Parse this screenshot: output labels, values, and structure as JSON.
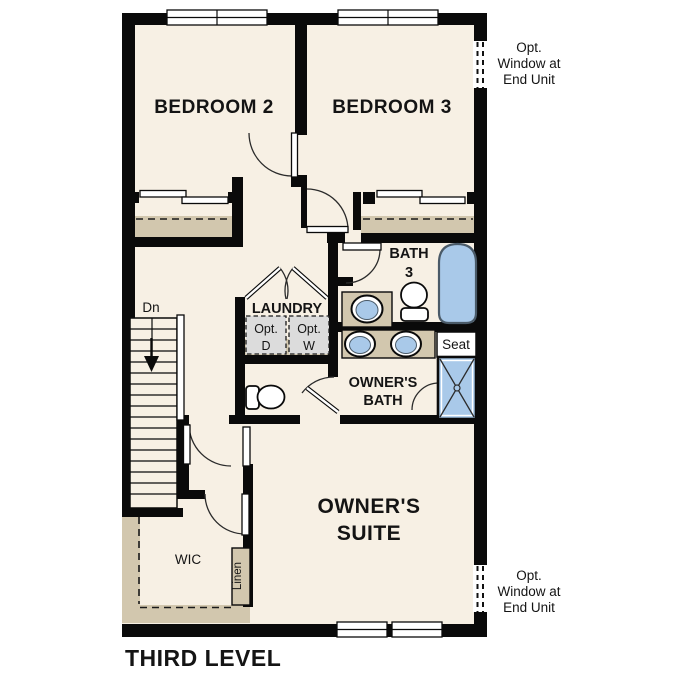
{
  "plan": {
    "title": "THIRD LEVEL",
    "rooms": {
      "bedroom2": {
        "label": "BEDROOM 2"
      },
      "bedroom3": {
        "label": "BEDROOM 3"
      },
      "bath3": {
        "line1": "BATH",
        "line2": "3"
      },
      "laundry": {
        "label": "LAUNDRY",
        "opt_dryer": {
          "line1": "Opt.",
          "line2": "D"
        },
        "opt_washer": {
          "line1": "Opt.",
          "line2": "W"
        }
      },
      "owners_bath": {
        "line1": "OWNER'S",
        "line2": "BATH",
        "seat": "Seat"
      },
      "owners_suite": {
        "line1": "OWNER'S",
        "line2": "SUITE"
      },
      "wic": {
        "label": "WIC",
        "linen": "Linen"
      },
      "stairs": {
        "direction": "Dn"
      }
    },
    "notes": {
      "opt_window_top": {
        "line1": "Opt.",
        "line2": "Window at",
        "line3": "End Unit"
      },
      "opt_window_bottom": {
        "line1": "Opt.",
        "line2": "Window at",
        "line3": "End Unit"
      }
    },
    "colors": {
      "wall": "#0a0a0a",
      "floor": "#f7f0e4",
      "millwork_tan": "#d2c7ae",
      "fixture_blue": "#a9c9e9",
      "fixture_outline": "#4a5a68",
      "optional_appliance_gray": "#dcdcdc",
      "page_background": "#ffffff"
    }
  }
}
